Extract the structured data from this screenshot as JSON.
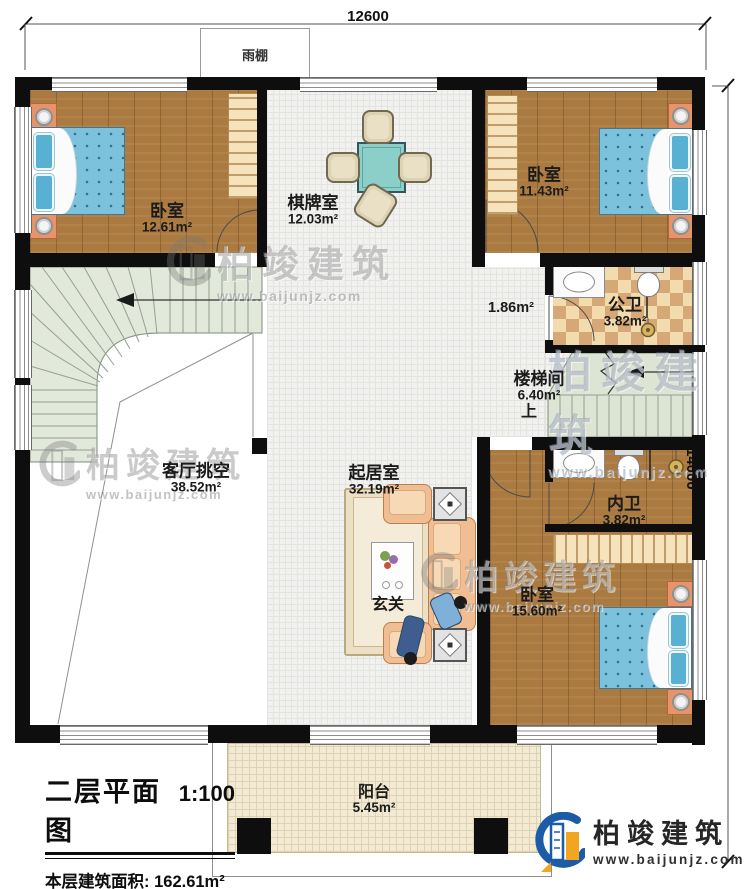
{
  "dimensions": {
    "width_mm": "12600",
    "depth_mm": "14000"
  },
  "canopy_label": "雨棚",
  "rooms": {
    "bedroom_top_left": {
      "name": "卧室",
      "area": "12.61m²"
    },
    "game_room": {
      "name": "棋牌室",
      "area": "12.03m²"
    },
    "bedroom_top_right": {
      "name": "卧室",
      "area": "11.43m²"
    },
    "public_bath": {
      "name": "公卫",
      "area": "3.82m²"
    },
    "hall_nook": {
      "area": "1.86m²"
    },
    "stairwell": {
      "name": "楼梯间",
      "area": "6.40m²",
      "up": "上"
    },
    "living_void": {
      "name": "客厅挑空",
      "area": "38.52m²"
    },
    "sitting_room": {
      "name": "起居室",
      "area": "32.19m²"
    },
    "entry": {
      "name": "玄关"
    },
    "private_bath": {
      "name": "内卫",
      "area": "3.82m²"
    },
    "bedroom_bottom_right": {
      "name": "卧室",
      "area": "15.60m²"
    },
    "balcony": {
      "name": "阳台",
      "area": "5.45m²"
    }
  },
  "title_block": {
    "title": "二层平面图",
    "scale": "1:100",
    "area_label": "本层建筑面积:",
    "area_value": "162.61m²",
    "height_label": "层高:",
    "height_value": "3.3m"
  },
  "logo": {
    "company": "柏竣建筑",
    "website": "www.baijunjz.com"
  },
  "watermark": {
    "company": "柏竣建筑",
    "website": "www.baijunjz.com"
  },
  "colors": {
    "wall": "#0e0e0e",
    "wood_floor": "#aa7a40",
    "tile_floor": "#f1f1ef",
    "bath_tile_light": "#f2dcae",
    "bath_tile_dark": "#d7a877",
    "stair_green": "#e2e8da",
    "balcony_floor": "#f2ead4",
    "bed_blue": "#7cc2dc",
    "sofa_peach": "#f1bd92",
    "table_teal": "#8ccfc9",
    "nightstand_orange": "#e8946a",
    "logo_blue": "#1c5ca6",
    "logo_orange": "#f2a51f"
  }
}
